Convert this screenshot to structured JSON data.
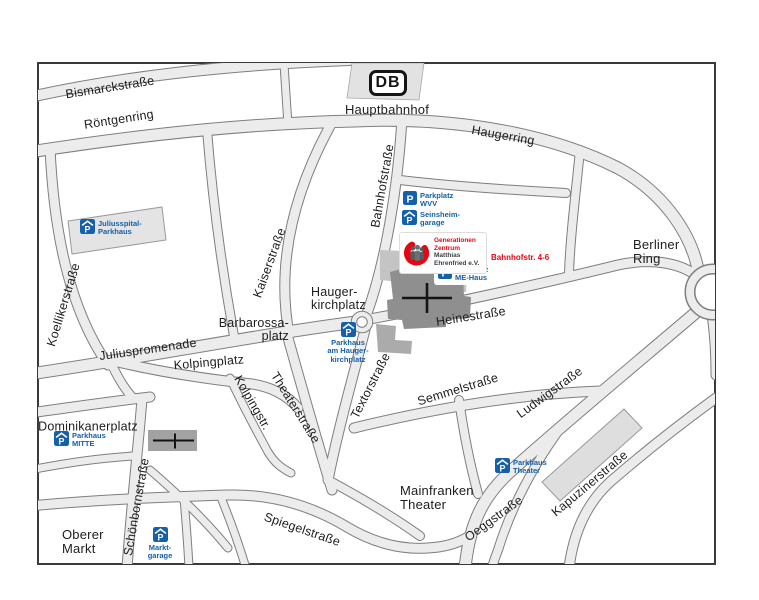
{
  "station": {
    "db_logo": "DB",
    "name": "Hauptbahnhof"
  },
  "streets": {
    "bismarckstrasse": "Bismarckstraße",
    "roentgenring": "Röntgenring",
    "haugerring": "Haugerring",
    "bahnhofstrasse": "Bahnhofstraße",
    "kaiserstrasse": "Kaiserstraße",
    "koellikerstrasse": "Koellikerstraße",
    "juliuspromenade": "Juliuspromenade",
    "kolpingstr": "Kolpingstr.",
    "theaterstrasse": "Theaterstraße",
    "textorstrasse": "Textorstraße",
    "schoenbornstrasse": "Schönbornstraße",
    "heinestrasse": "Heinestraße",
    "semmelstrasse": "Semmelstraße",
    "ludwigstrasse": "Ludwigstraße",
    "kapuzinerstrasse": "Kapuzinerstraße",
    "spiegelstrasse": "Spiegelstraße",
    "oeggstrasse": "Oeggstraße"
  },
  "places": {
    "berliner_ring": "Berliner\nRing",
    "barbarossaplatz": "Barbarossa-\nplatz",
    "haugerkirchplatz": "Hauger-\nkirchplatz",
    "kolpingplatz": "Kolpingplatz",
    "dominikanerplatz": "Dominikanerplatz",
    "oberer_markt": "Oberer\nMarkt",
    "mainfranken_theater": "Mainfranken\nTheater"
  },
  "parking": {
    "wvv": "Parkplatz\nWVV",
    "seinsheim": "Seinsheim-\ngarage",
    "mehaus": "Parkplatz\nME-Haus",
    "juliusspital": "Juliusspital-\nParkhaus",
    "hauger": "Parkhaus\nam Hauger-\nkirchplatz",
    "mitte": "Parkhaus\nMITTE",
    "markt": "Markt-\ngarage",
    "theater": "Parkhaus\nTheater"
  },
  "gz": {
    "line1": "Generationen",
    "line2": "Zentrum",
    "line3": "Matthias",
    "line4": "Ehrenfried e.V.",
    "address": "Bahnhofstr. 4-6"
  },
  "colors": {
    "parking_blue": "#1560a9",
    "accent_red": "#e30613"
  }
}
